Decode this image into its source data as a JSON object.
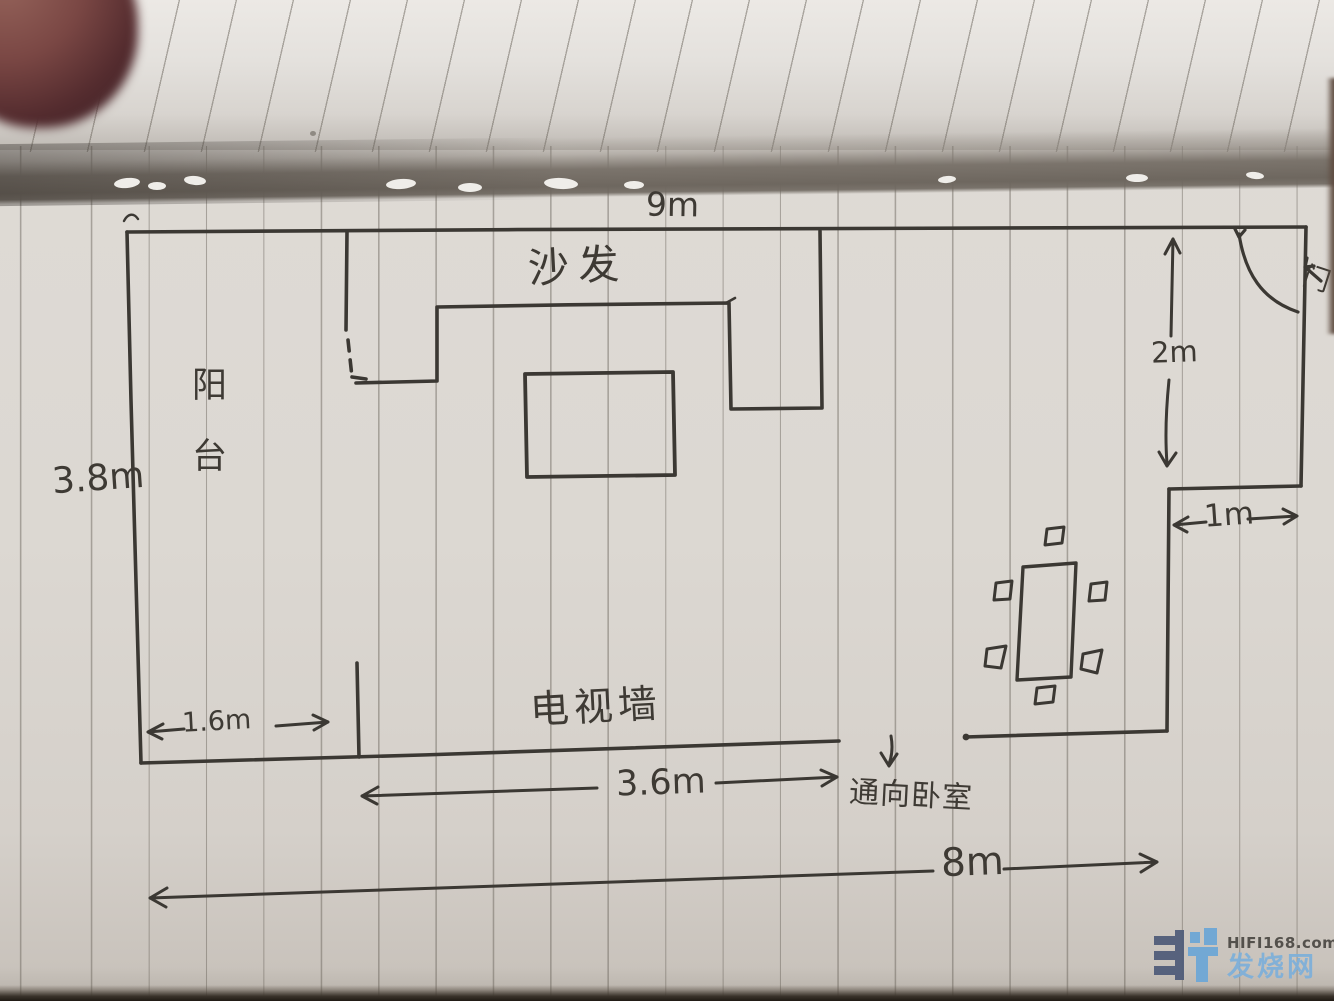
{
  "sketch": {
    "room": {
      "top_width_label": "9m",
      "left_height_label": "3.8m",
      "entry_depth_label": "2m",
      "entry_width_label": "1m",
      "balcony_strip_label": "1.6m",
      "tv_wall_width_label": "3.6m",
      "bottom_width_label": "8m"
    },
    "annotations": {
      "sofa": "沙发",
      "balcony": "阳台",
      "tv_wall": "电视墙",
      "to_bedroom": "通向卧室",
      "door": "门"
    }
  },
  "watermark": {
    "site": "HIFI168.com",
    "site_name": "发烧网"
  },
  "colors": {
    "paper": "#ddd8d2",
    "ink": "#3b3833",
    "ruling": "#6f685f",
    "logo_dark": "#515d7a",
    "logo_light": "#6ea7d6"
  }
}
